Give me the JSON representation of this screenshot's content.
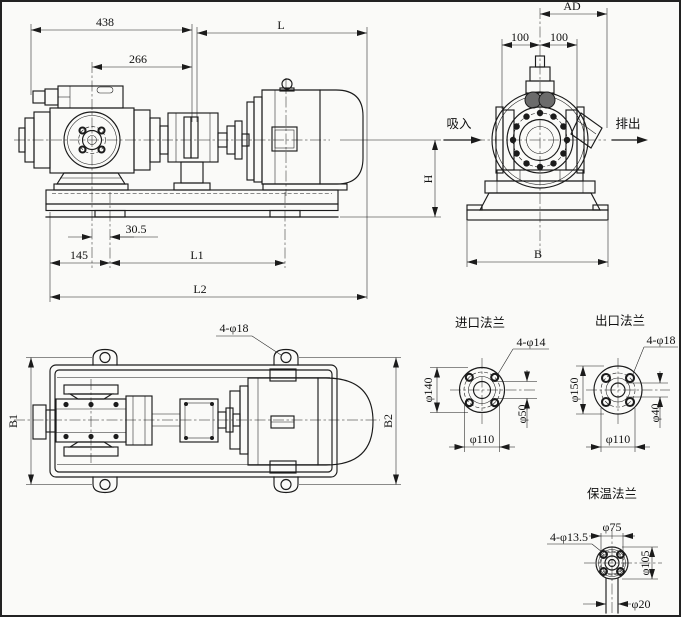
{
  "colors": {
    "ink": "#1b1b1b",
    "paper": "#fafaf8"
  },
  "views": {
    "side": {
      "dim_438": "438",
      "dim_266": "266",
      "dim_L": "L",
      "dim_30_5": "30.5",
      "dim_145": "145",
      "dim_L1": "L1",
      "dim_L2": "L2",
      "dim_H": "H"
    },
    "end": {
      "dim_AD": "AD",
      "dim_100_left": "100",
      "dim_100_right": "100",
      "dim_B": "B",
      "label_suction": "吸入",
      "label_discharge": "排出"
    },
    "plan": {
      "dim_B1": "B1",
      "dim_B2": "B2",
      "callout_mount_holes": "4-φ18"
    },
    "flanges": {
      "inlet": {
        "title": "进口法兰",
        "callout_bolts": "4-φ14",
        "dim_od": "φ140",
        "dim_bolt_circle": "φ110",
        "dim_bore": "φ50"
      },
      "outlet": {
        "title": "出口法兰",
        "callout_bolts": "4-φ18",
        "dim_od": "φ150",
        "dim_bolt_circle": "φ110",
        "dim_bore": "φ40"
      },
      "insulation": {
        "title": "保温法兰",
        "callout_bolts": "4-φ13.5",
        "dim_face": "φ75",
        "dim_od": "φ105",
        "dim_pipe": "φ20"
      }
    }
  }
}
